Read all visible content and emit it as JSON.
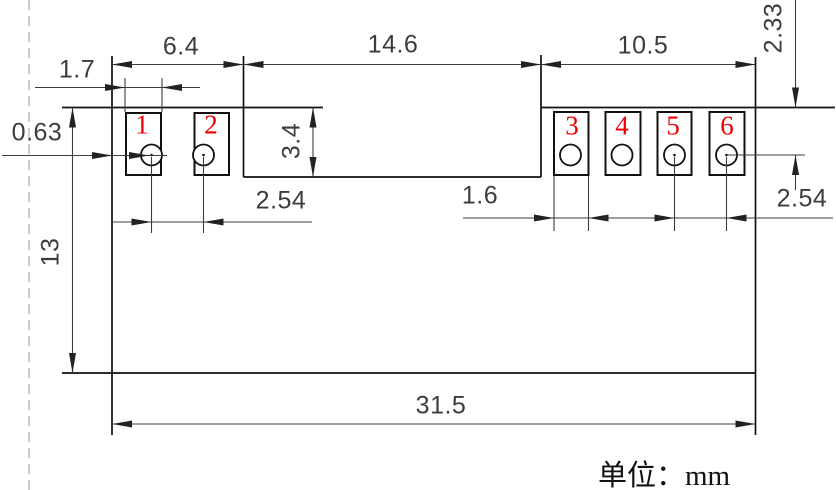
{
  "drawing": {
    "type": "mechanical-dimension-drawing",
    "unit_note": "单位：mm",
    "pins": [
      "1",
      "2",
      "3",
      "4",
      "5",
      "6"
    ],
    "dimensions": {
      "left_pad_group_width": "6.4",
      "middle_section_width": "14.6",
      "right_pad_group_width": "10.5",
      "pad_width_left": "1.7",
      "edge_to_hole": "0.63",
      "middle_section_depth": "3.4",
      "hole_pitch_left": "2.54",
      "pad_width_right": "1.6",
      "hole_pitch_right": "2.54",
      "top_edge_to_hole_center": "2.33",
      "body_height": "13",
      "body_width": "31.5"
    },
    "colors": {
      "outline": "#111111",
      "dimension": "#3c3c3c",
      "pin_number": "#ee0000",
      "construction_line": "#aaaaaa",
      "background": "#ffffff"
    }
  }
}
